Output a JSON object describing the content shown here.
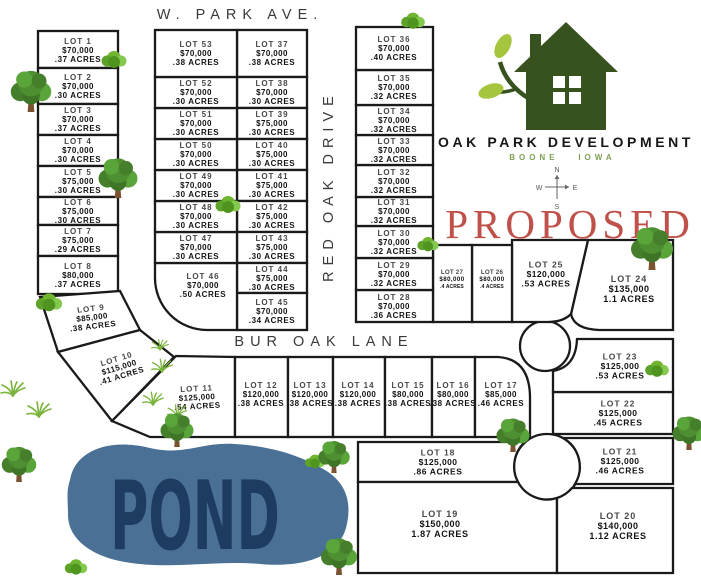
{
  "streets": {
    "w_park_ave": "W. PARK AVE.",
    "red_oak_drive": "RED OAK DRIVE",
    "bur_oak_lane": "BUR OAK LANE"
  },
  "pond": {
    "label": "POND"
  },
  "branding": {
    "name": "OAK PARK DEVELOPMENT",
    "city": "BOONE",
    "state": "IOWA",
    "status": "PROPOSED",
    "colors": {
      "logo_green": "#37521f",
      "leaf_green": "#a6c53e",
      "location_green": "#7fa053",
      "accent_red": "#c0504a",
      "pond_blue": "#4a7195",
      "pond_text_navy": "#1e3c61"
    }
  },
  "compass": {
    "n": "N",
    "e": "E",
    "s": "S",
    "w": "W"
  },
  "icons": {
    "tree": "tree-icon",
    "bush": "bush-icon",
    "grass": "grass-icon",
    "house": "house-logo-icon",
    "compass": "compass-rose-icon"
  },
  "lots": [
    {
      "id": "LOT 1",
      "price": "$70,000",
      "acres": ".37 ACRES"
    },
    {
      "id": "LOT 2",
      "price": "$70,000",
      "acres": ".30 ACRES"
    },
    {
      "id": "LOT 3",
      "price": "$70,000",
      "acres": ".37 ACRES"
    },
    {
      "id": "LOT 4",
      "price": "$70,000",
      "acres": ".30 ACRES"
    },
    {
      "id": "LOT 5",
      "price": "$75,000",
      "acres": ".30 ACRES"
    },
    {
      "id": "LOT 6",
      "price": "$75,000",
      "acres": ".30 ACRES"
    },
    {
      "id": "LOT 7",
      "price": "$75,000",
      "acres": ".29 ACRES"
    },
    {
      "id": "LOT 8",
      "price": "$80,000",
      "acres": ".37 ACRES"
    },
    {
      "id": "LOT 9",
      "price": "$85,000",
      "acres": ".38 ACRES"
    },
    {
      "id": "LOT 10",
      "price": "$115,000",
      "acres": ".41 ACRES"
    },
    {
      "id": "LOT 11",
      "price": "$125,000",
      "acres": ".54 ACRES"
    },
    {
      "id": "LOT 12",
      "price": "$120,000",
      "acres": ".38 ACRES"
    },
    {
      "id": "LOT 13",
      "price": "$120,000",
      "acres": ".38 ACRES"
    },
    {
      "id": "LOT 14",
      "price": "$120,000",
      "acres": ".38 ACRES"
    },
    {
      "id": "LOT 15",
      "price": "$80,000",
      "acres": ".38 ACRES"
    },
    {
      "id": "LOT 16",
      "price": "$80,000",
      "acres": ".38 ACRES"
    },
    {
      "id": "LOT 17",
      "price": "$85,000",
      "acres": ".46 ACRES"
    },
    {
      "id": "LOT 18",
      "price": "$125,000",
      "acres": ".86 ACRES"
    },
    {
      "id": "LOT 19",
      "price": "$150,000",
      "acres": "1.87 ACRES"
    },
    {
      "id": "LOT 20",
      "price": "$140,000",
      "acres": "1.12 ACRES"
    },
    {
      "id": "LOT 21",
      "price": "$125,000",
      "acres": ".46 ACRES"
    },
    {
      "id": "LOT 22",
      "price": "$125,000",
      "acres": ".45 ACRES"
    },
    {
      "id": "LOT 23",
      "price": "$125,000",
      "acres": ".53 ACRES"
    },
    {
      "id": "LOT 24",
      "price": "$135,000",
      "acres": "1.1 ACRES"
    },
    {
      "id": "LOT 25",
      "price": "$120,000",
      "acres": ".53 ACRES"
    },
    {
      "id": "LOT 26",
      "price": "$80,000",
      "acres": ".4 ACRES"
    },
    {
      "id": "LOT 27",
      "price": "$80,000",
      "acres": ".4 ACRES"
    },
    {
      "id": "LOT 28",
      "price": "$70,000",
      "acres": ".36 ACRES"
    },
    {
      "id": "LOT 29",
      "price": "$70,000",
      "acres": ".32 ACRES"
    },
    {
      "id": "LOT 30",
      "price": "$70,000",
      "acres": ".32 ACRES"
    },
    {
      "id": "LOT 31",
      "price": "$70,000",
      "acres": ".32 ACRES"
    },
    {
      "id": "LOT 32",
      "price": "$70,000",
      "acres": ".32 ACRES"
    },
    {
      "id": "LOT 33",
      "price": "$70,000",
      "acres": ".32 ACRES"
    },
    {
      "id": "LOT 34",
      "price": "$70,000",
      "acres": ".32 ACRES"
    },
    {
      "id": "LOT 35",
      "price": "$70,000",
      "acres": ".32 ACRES"
    },
    {
      "id": "LOT 36",
      "price": "$70,000",
      "acres": ".40 ACRES"
    },
    {
      "id": "LOT 37",
      "price": "$70,000",
      "acres": ".38 ACRES"
    },
    {
      "id": "LOT 38",
      "price": "$70,000",
      "acres": ".30 ACRES"
    },
    {
      "id": "LOT 39",
      "price": "$75,000",
      "acres": ".30 ACRES"
    },
    {
      "id": "LOT 40",
      "price": "$75,000",
      "acres": ".30 ACRES"
    },
    {
      "id": "LOT 41",
      "price": "$75,000",
      "acres": ".30 ACRES"
    },
    {
      "id": "LOT 42",
      "price": "$75,000",
      "acres": ".30 ACRES"
    },
    {
      "id": "LOT 43",
      "price": "$75,000",
      "acres": ".30 ACRES"
    },
    {
      "id": "LOT 44",
      "price": "$75,000",
      "acres": ".30 ACRES"
    },
    {
      "id": "LOT 45",
      "price": "$70,000",
      "acres": ".34 ACRES"
    },
    {
      "id": "LOT 46",
      "price": "$70,000",
      "acres": ".50 ACRES"
    },
    {
      "id": "LOT 47",
      "price": "$70,000",
      "acres": ".30 ACRES"
    },
    {
      "id": "LOT 48",
      "price": "$70,000",
      "acres": ".30 ACRES"
    },
    {
      "id": "LOT 49",
      "price": "$70,000",
      "acres": ".30 ACRES"
    },
    {
      "id": "LOT 50",
      "price": "$70,000",
      "acres": ".30 ACRES"
    },
    {
      "id": "LOT 51",
      "price": "$70,000",
      "acres": ".30 ACRES"
    },
    {
      "id": "LOT 52",
      "price": "$70,000",
      "acres": ".30 ACRES"
    },
    {
      "id": "LOT 53",
      "price": "$70,000",
      "acres": ".38 ACRES"
    }
  ]
}
